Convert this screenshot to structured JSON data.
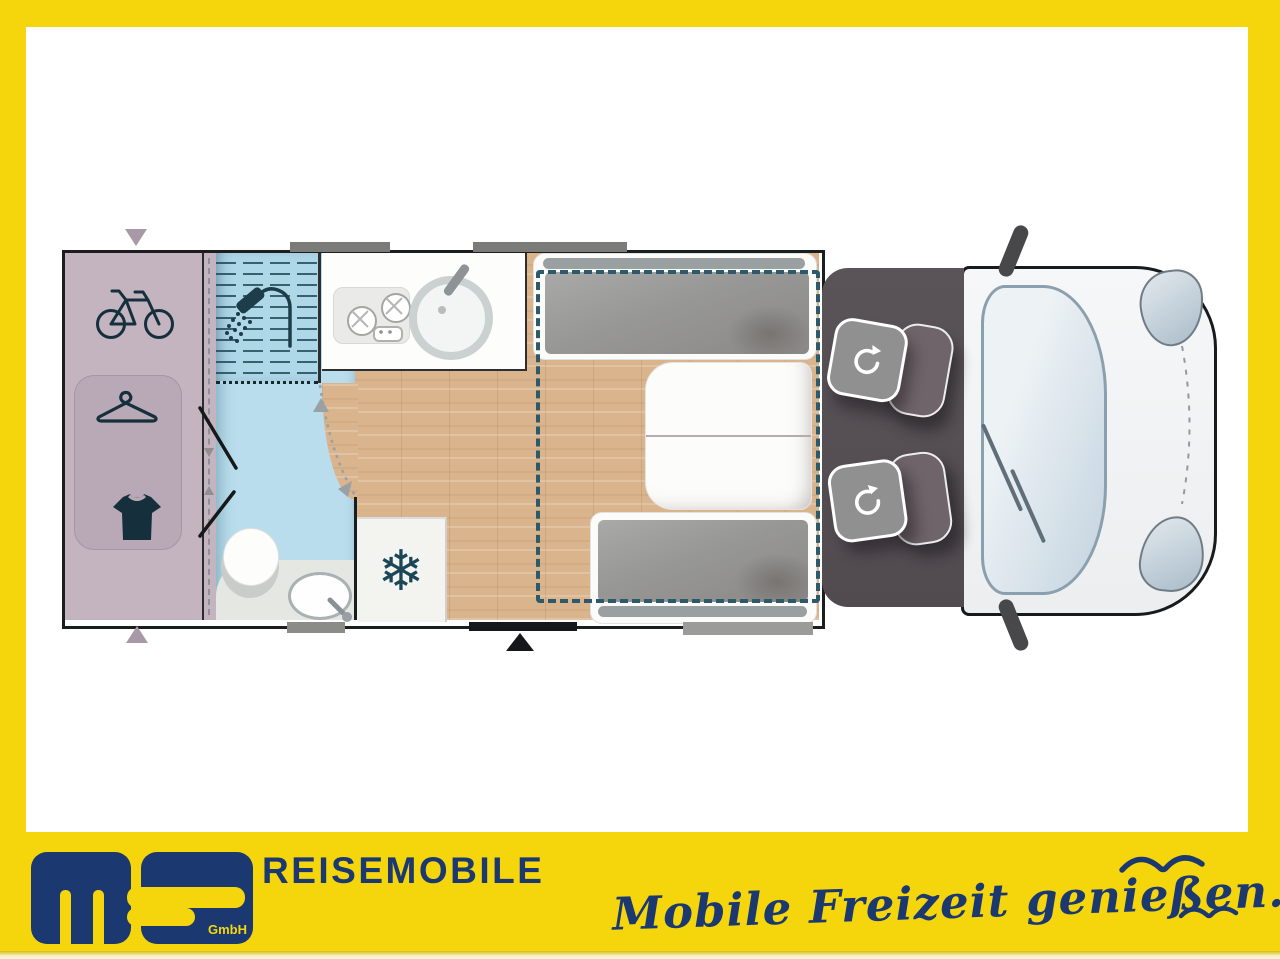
{
  "colors": {
    "yellow": "#F5D60D",
    "navy": "#1B3970",
    "wood": "#d9b48c",
    "garage_mauve": "#c3b4bf",
    "bath_blue": "#b9ddec",
    "bed_outline_teal": "#2d5a6b",
    "icon_slate": "#15303c",
    "cab_gray": "#575156",
    "cushion_gray": "#979795"
  },
  "footer": {
    "company": "REISEMOBILE",
    "tagline": "Mobile Freizeit genießen.",
    "logo_sub": "GmbH"
  },
  "floorplan": {
    "garage": {
      "icons": [
        "bicycle",
        "hanger",
        "tshirt"
      ]
    },
    "bathroom": {
      "features": [
        "shower",
        "toilet",
        "washbasin",
        "folding-door"
      ]
    },
    "kitchen": {
      "features": [
        "two-burner-hob",
        "round-sink"
      ]
    },
    "fridge": {
      "glyph": "❄"
    },
    "dinette": {
      "features": [
        "front-bench",
        "table",
        "rear-bench",
        "drop-down-bed-outline"
      ]
    },
    "cab": {
      "features": [
        "swivel-seat-driver",
        "swivel-seat-passenger",
        "windshield",
        "side-mirrors",
        "headlights"
      ]
    },
    "exterior": {
      "features": [
        "skylights",
        "entry-door",
        "steps",
        "garage-door-arrows"
      ]
    }
  }
}
